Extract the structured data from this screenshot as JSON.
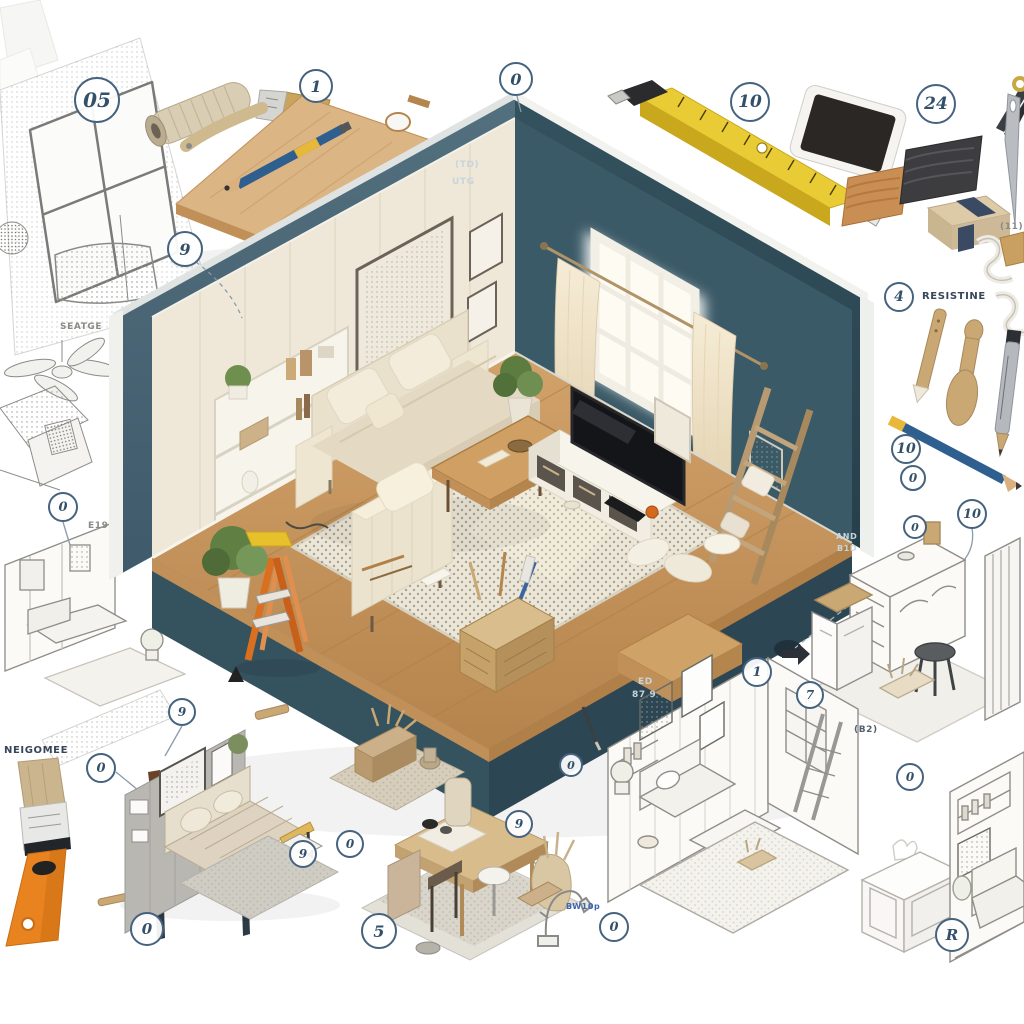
{
  "title": "Isometric living room renovation infographic",
  "badges": [
    "05",
    "1",
    "0",
    "10",
    "24",
    "9",
    "4",
    "10",
    "0",
    "0",
    "10",
    "0",
    "9",
    "0",
    "0",
    "9",
    "0",
    "5",
    "9",
    "0",
    "0",
    "1",
    "7",
    "0",
    "R"
  ],
  "labels": {
    "resistine": "RESISTINE",
    "wall_code_line1": "(TD)",
    "wall_code_line2": "UTG",
    "base_code_line1": "ED",
    "base_code_line2": "87 9",
    "side_code_line1": "AND",
    "side_code_line2": "B1D",
    "sketch_caption_top": "SEATGE",
    "sketch_caption_e19": "E19",
    "brush_caption": "NEIGOMEE",
    "plan_code": "(B2)",
    "needle_code": "(11)",
    "faucet_code": "BW10p"
  },
  "palette": {
    "wall_exterior_left": "#4e6877",
    "wall_exterior_right": "#2e4854",
    "wall_interior_cream": "#efe8d8",
    "wall_interior_teal": "#3b5a67",
    "floor_wood": "#cb9d66",
    "rug_cream": "#ece6d6",
    "ladder_orange": "#d96f1f",
    "tape_measure_yellow": "#e9cb35",
    "pencil_blue": "#2f5f8f",
    "badge_ink": "#33506b",
    "sketch_line": "#8f8d88"
  },
  "items": [
    "sketch-window-room",
    "sandpaper-roll",
    "paint-brush",
    "wood-board",
    "blue-pencil",
    "tape-measure",
    "tablet",
    "scissors",
    "wood-swatch-light",
    "wood-swatch-dark",
    "sanding-block",
    "sewing-needle",
    "thread",
    "carving-stick",
    "wooden-handle-tool",
    "marker-pen",
    "isometric-living-room",
    "sofa",
    "armchair",
    "coffee-table",
    "tv-console",
    "television",
    "window-with-curtains",
    "leaning-ladder",
    "step-ladder",
    "tool-basket",
    "ceiling-fan-sketch",
    "bedroom-sketch",
    "living-room-sketch-left",
    "flat-paintbrush-orange",
    "artist-brush",
    "artist-brush-small",
    "gray-room-vignette",
    "rug-basket-vignette",
    "dining-room-vignette",
    "faucet-sketch",
    "desk-vignette-sketch",
    "living-room-sketch-large",
    "white-cabinet",
    "reading-nook-sketch"
  ]
}
